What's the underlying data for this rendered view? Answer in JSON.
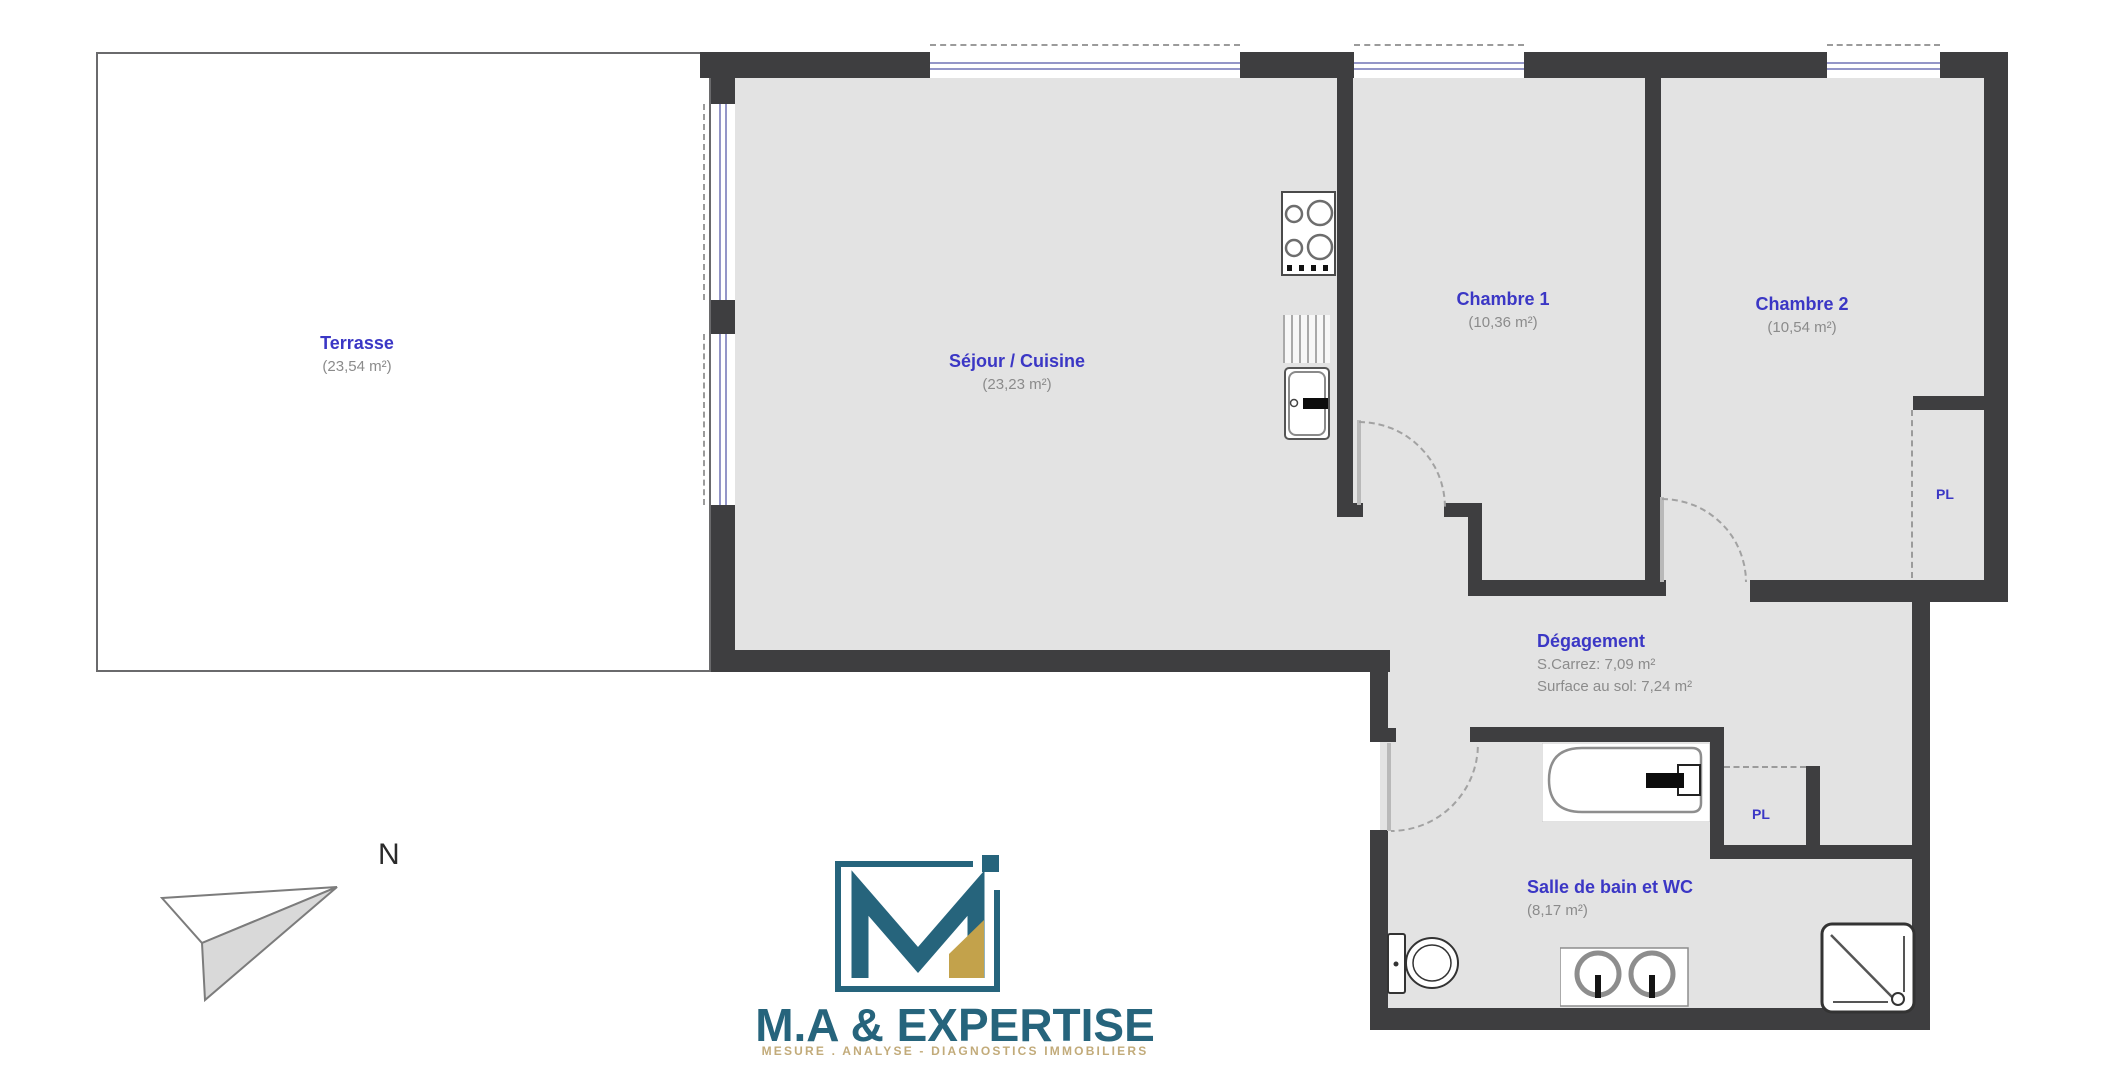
{
  "plan": {
    "rooms": {
      "terrasse": {
        "name": "Terrasse",
        "area": "(23,54 m²)"
      },
      "sejour_cuisine": {
        "name": "Séjour / Cuisine",
        "area": "(23,23 m²)"
      },
      "chambre1": {
        "name": "Chambre 1",
        "area": "(10,36 m²)"
      },
      "chambre2": {
        "name": "Chambre 2",
        "area": "(10,54 m²)"
      },
      "degagement": {
        "name": "Dégagement",
        "carrez": "S.Carrez: 7,09 m²",
        "floor_area": "Surface au sol: 7,24 m²"
      },
      "salle_de_bain": {
        "name": "Salle de bain et WC",
        "area": "(8,17 m²)"
      }
    },
    "closets": {
      "pl_chambre2": "PL",
      "pl_degagement": "PL"
    },
    "compass": {
      "north": "N"
    }
  },
  "logo": {
    "company": "M.A & EXPERTISE",
    "tagline": "MESURE . ANALYSE - DIAGNOSTICS IMMOBILIERS"
  },
  "colors": {
    "wall": "#3e3e40",
    "floor": "#e3e3e3",
    "room_label_blue": "#3b37c5",
    "area_text_gray": "#8b8b8b",
    "window_blue": "#9496c8",
    "logo_teal": "#26647c",
    "logo_gold": "#c3a24b"
  }
}
